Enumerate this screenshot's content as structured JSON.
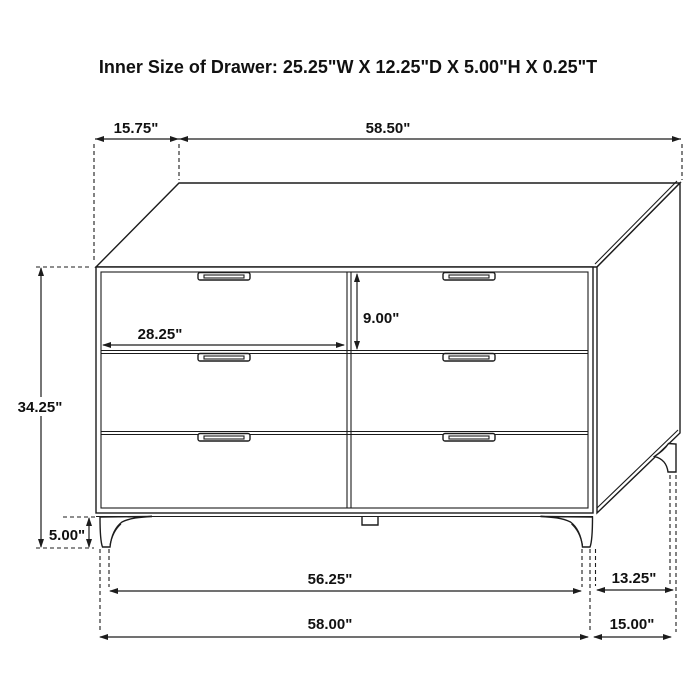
{
  "title": "Inner Size of Drawer: 25.25\"W X 12.25\"D X 5.00\"H X 0.25\"T",
  "dimensions": {
    "top_back_offset": "15.75\"",
    "top_width": "58.50\"",
    "overall_height": "34.25\"",
    "leg_height": "5.00\"",
    "drawer_width": "28.25\"",
    "drawer_height": "9.00\"",
    "base_width_between_feet": "56.25\"",
    "base_width_overall": "58.00\"",
    "side_depth_between_feet": "13.25\"",
    "side_depth_overall": "15.00\""
  },
  "colors": {
    "line": "#1c1c1c",
    "background": "#ffffff",
    "text": "#111111"
  }
}
